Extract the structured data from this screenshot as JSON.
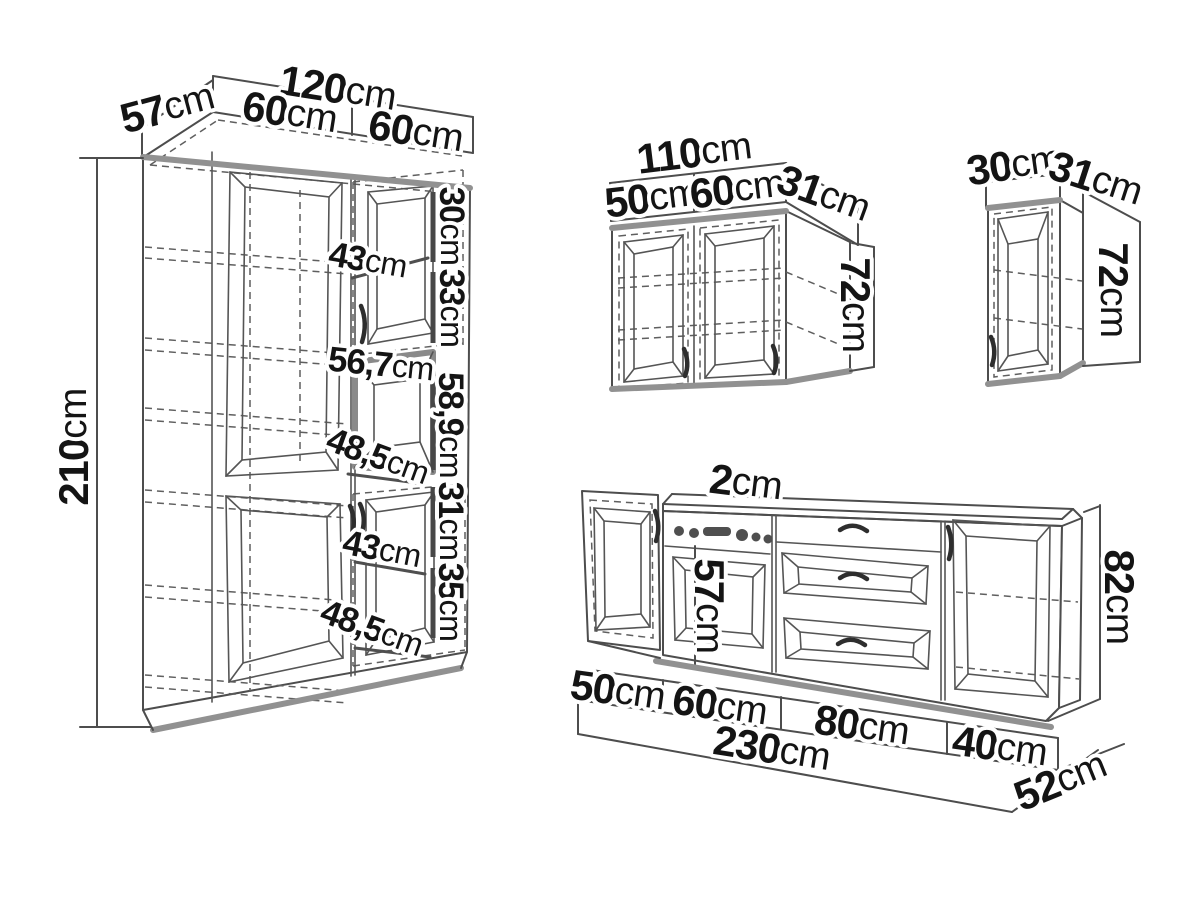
{
  "unit": "cm",
  "diagram_title": "kitchen cabinet set dimensions",
  "tall_cabinet": {
    "total_width": "120",
    "depth": "57",
    "left_door_width": "60",
    "right_door_width": "60",
    "height": "210",
    "top_door_height": "30",
    "top_door_diagonal": "43",
    "mid_door_height": "33",
    "niche_width": "56,7",
    "niche_height": "58,9",
    "niche_diagonal": "48,5",
    "lower_section_height": "31",
    "lower_door_diagonal": "43",
    "lower_door_height": "35",
    "bottom_diagonal": "48,5"
  },
  "wall_cabinet": {
    "total_width": "110",
    "left_door_width": "50",
    "right_door_width": "60",
    "depth": "31",
    "height": "72"
  },
  "small_wall_cabinet": {
    "width": "30",
    "depth": "31",
    "height": "72"
  },
  "base_run": {
    "countertop_thickness": "2",
    "oven_door_height": "57",
    "height": "82",
    "section_1_width": "50",
    "section_2_width": "60",
    "section_3_width": "80",
    "section_4_width": "40",
    "total_width": "230",
    "depth": "52"
  }
}
